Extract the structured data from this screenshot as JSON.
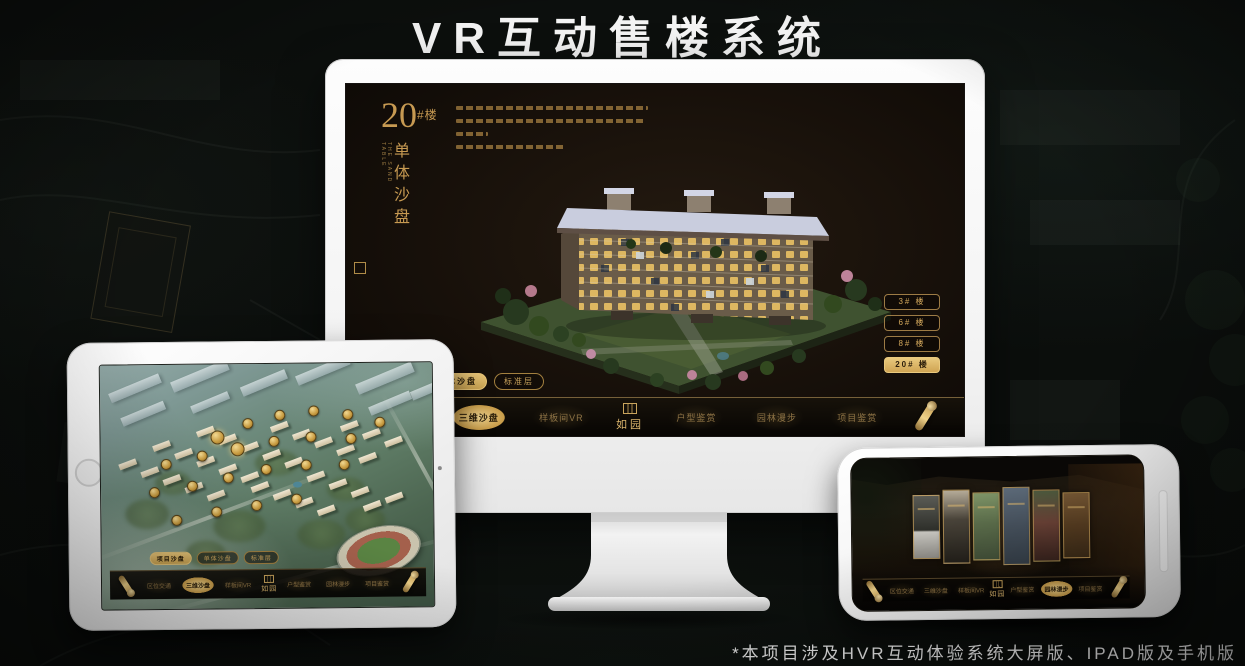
{
  "page": {
    "title": "VR互动售楼系统",
    "footnote": "*本项目涉及HVR互动体验系统大屏版、IPAD版及手机版"
  },
  "colors": {
    "gold": "#d2ab66",
    "gold_active_bg": "#ddb569",
    "screen_brown": "#1a120b",
    "stage_background": "#0b0e0c",
    "title_white": "#f4f4f4"
  },
  "monitor": {
    "title_block": {
      "number": "20",
      "suffix": "#楼",
      "subtitle": "单体沙盘",
      "subtitle_en": "THE SAND TABLE"
    },
    "building_buttons": [
      {
        "label": "3# 楼",
        "active": false
      },
      {
        "label": "6# 楼",
        "active": false
      },
      {
        "label": "8# 楼",
        "active": false
      },
      {
        "label": "20# 楼",
        "active": true
      }
    ],
    "tabs": [
      {
        "label": "项目沙盘",
        "active": false
      },
      {
        "label": "单体沙盘",
        "active": true
      },
      {
        "label": "标准层",
        "active": false
      }
    ],
    "nav": {
      "items_left": [
        {
          "label": "区位交通",
          "active": false
        },
        {
          "label": "三维沙盘",
          "active": true
        },
        {
          "label": "样板间VR",
          "active": false
        }
      ],
      "logo": "如园",
      "items_right": [
        {
          "label": "户型鉴赏",
          "active": false
        },
        {
          "label": "园林漫步",
          "active": false
        },
        {
          "label": "项目鉴赏",
          "active": false
        }
      ]
    }
  },
  "tablet": {
    "tabs": [
      {
        "label": "项目沙盘",
        "active": true
      },
      {
        "label": "单体沙盘",
        "active": false
      },
      {
        "label": "标准层",
        "active": false
      }
    ],
    "nav": {
      "items_left": [
        {
          "label": "区位交通",
          "active": false
        },
        {
          "label": "三维沙盘",
          "active": true
        },
        {
          "label": "样板间VR",
          "active": false
        }
      ],
      "logo": "如园",
      "items_right": [
        {
          "label": "户型鉴赏",
          "active": false
        },
        {
          "label": "园林漫步",
          "active": false
        },
        {
          "label": "项目鉴赏",
          "active": false
        }
      ]
    }
  },
  "phone": {
    "nav": {
      "items_left": [
        {
          "label": "区位交通",
          "active": false
        },
        {
          "label": "三维沙盘",
          "active": false
        },
        {
          "label": "样板间VR",
          "active": false
        }
      ],
      "logo": "如园",
      "items_right": [
        {
          "label": "户型鉴赏",
          "active": false
        },
        {
          "label": "园林漫步",
          "active": true
        },
        {
          "label": "项目鉴赏",
          "active": false
        }
      ]
    }
  }
}
